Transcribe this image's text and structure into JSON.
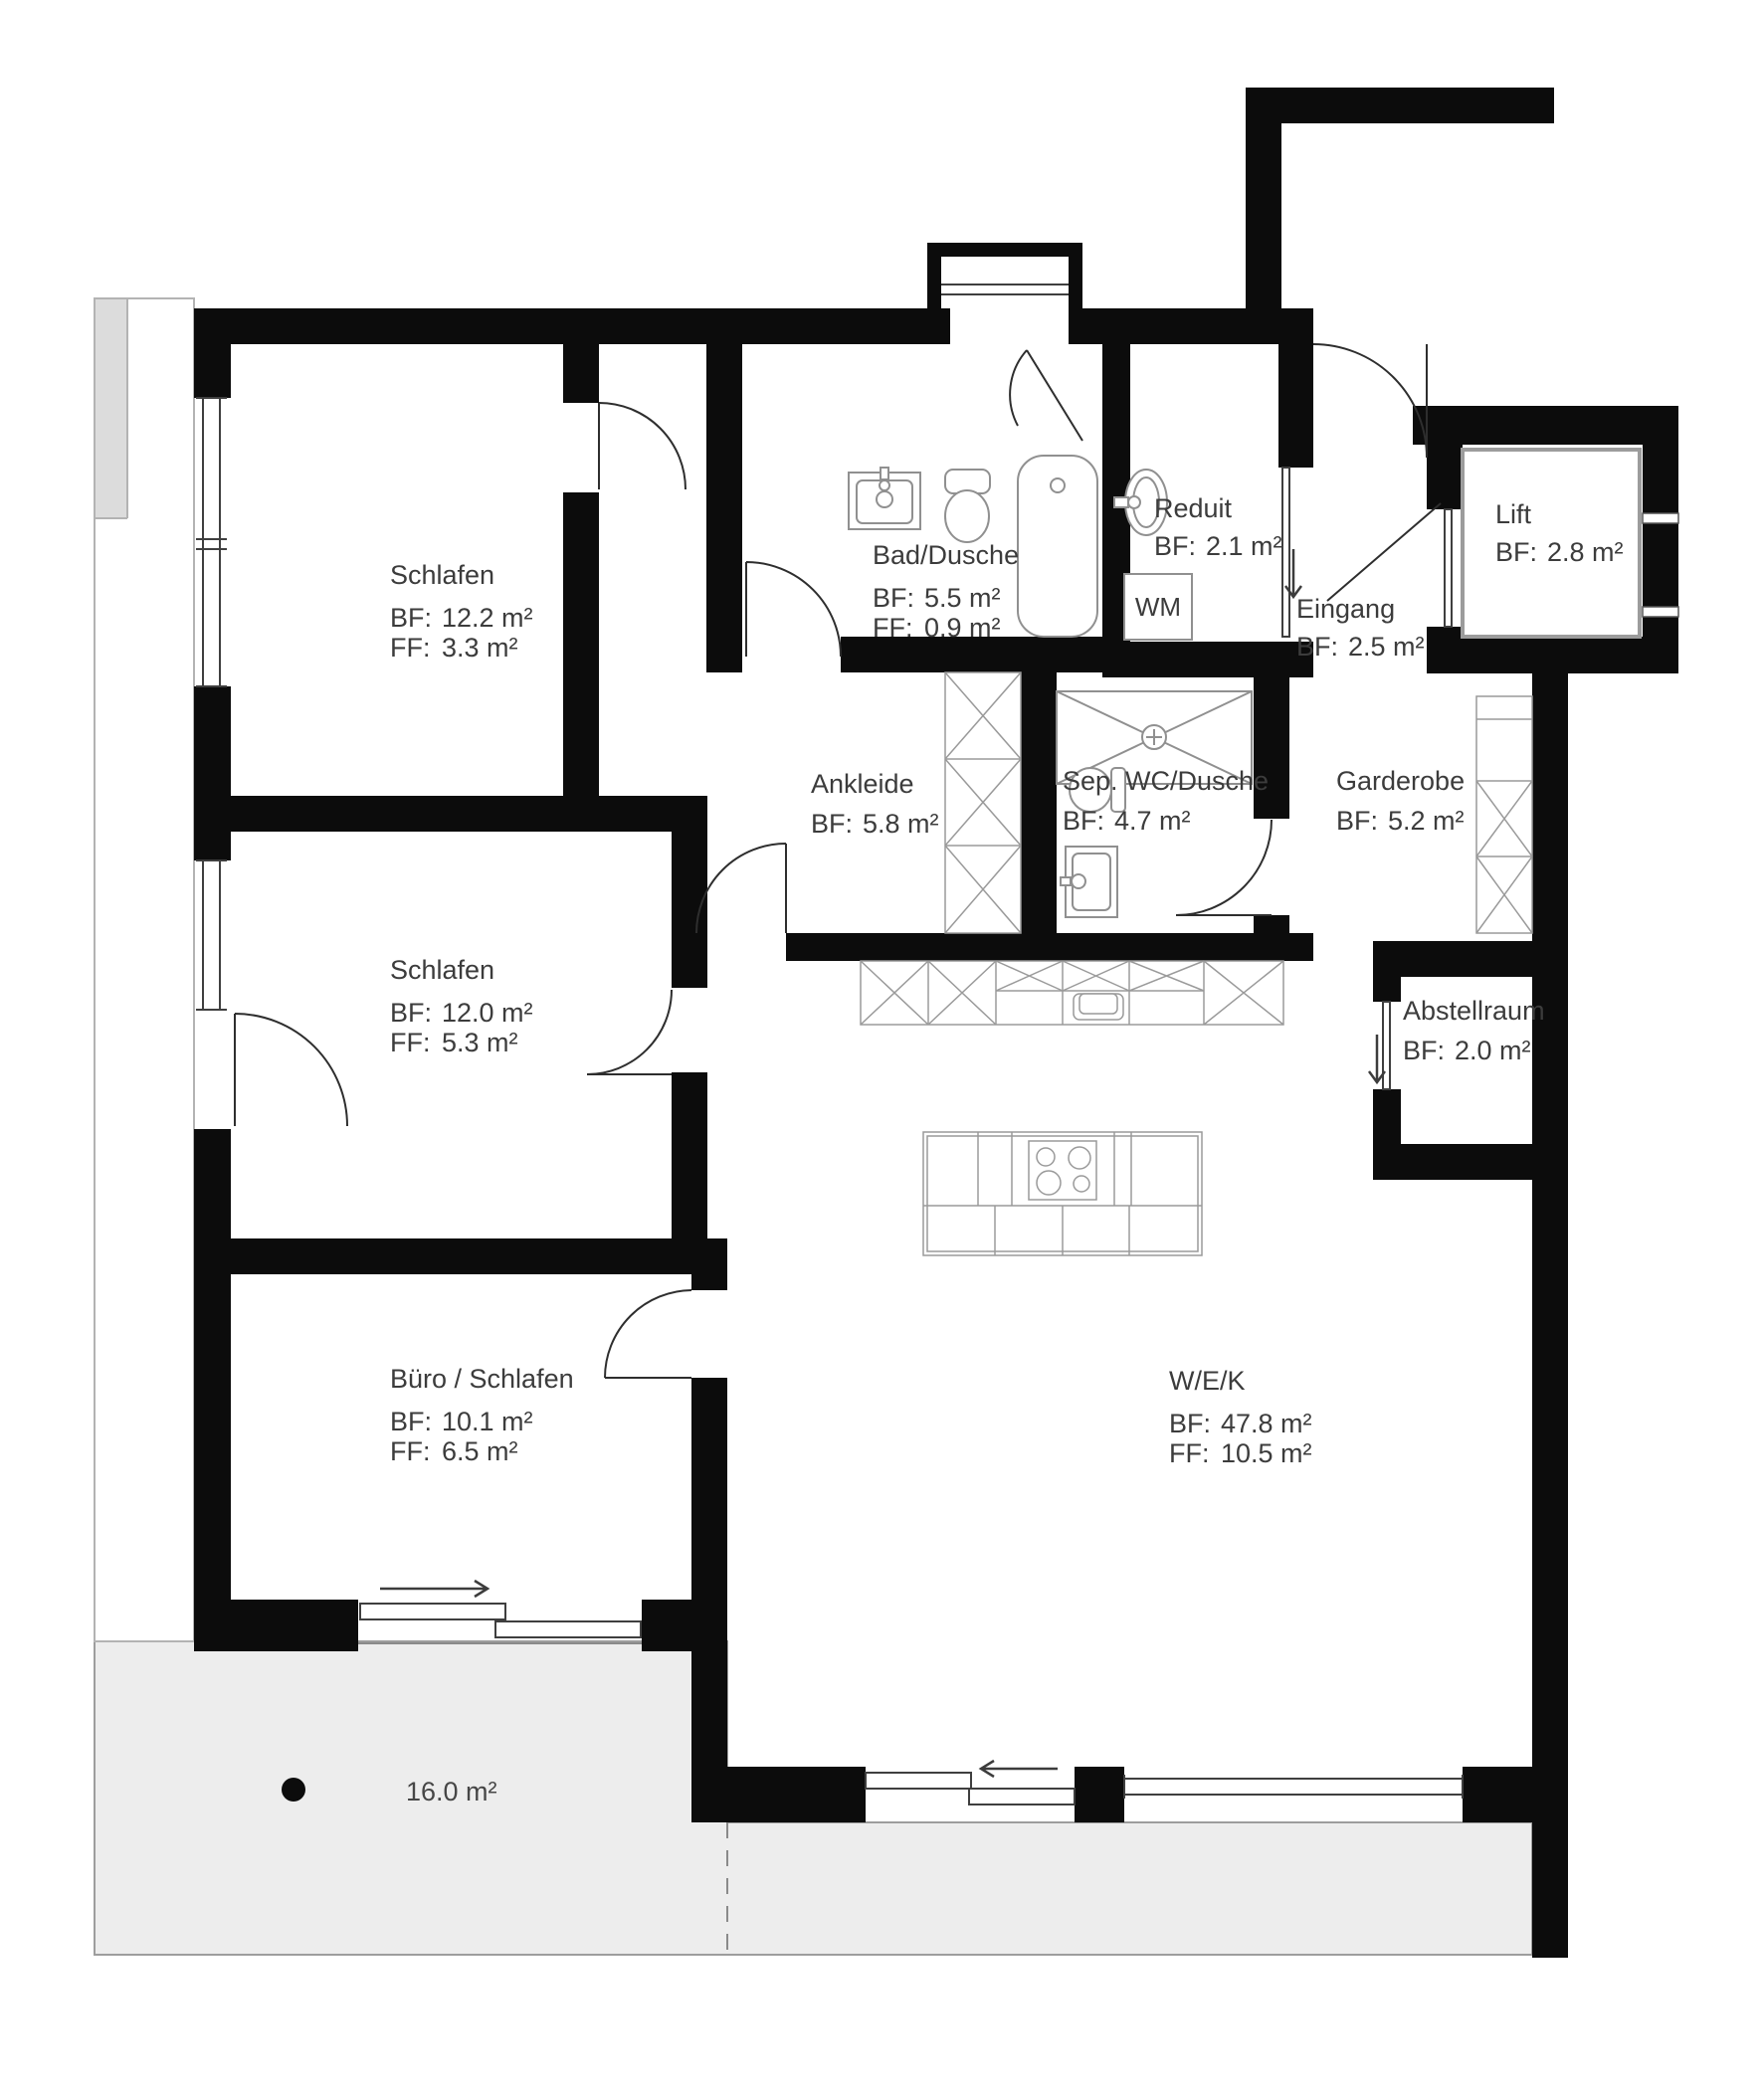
{
  "rooms": [
    {
      "id": "schlafen-1",
      "name": "Schlafen",
      "area_label": "BF:",
      "area": "12.2 m²",
      "floor_label": "FF:",
      "floor": "3.3 m²"
    },
    {
      "id": "bad-dusche",
      "name": "Bad/Dusche",
      "area_label": "BF:",
      "area": "5.5 m²",
      "floor_label": "FF:",
      "floor": "0.9 m²"
    },
    {
      "id": "reduit",
      "name": "Reduit",
      "area_label": "BF:",
      "area": "2.1 m²"
    },
    {
      "id": "eingang",
      "name": "Eingang",
      "area_label": "BF:",
      "area": "2.5 m²"
    },
    {
      "id": "lift",
      "name": "Lift",
      "area_label": "BF:",
      "area": "2.8 m²"
    },
    {
      "id": "ankleide",
      "name": "Ankleide",
      "area_label": "BF:",
      "area": "5.8 m²"
    },
    {
      "id": "sep-wc-dusche",
      "name": "Sep. WC/Dusche",
      "area_label": "BF:",
      "area": "4.7 m²"
    },
    {
      "id": "garderobe",
      "name": "Garderobe",
      "area_label": "BF:",
      "area": "5.2 m²"
    },
    {
      "id": "schlafen-2",
      "name": "Schlafen",
      "area_label": "BF:",
      "area": "12.0 m²",
      "floor_label": "FF:",
      "floor": "5.3 m²"
    },
    {
      "id": "abstellraum",
      "name": "Abstellraum",
      "area_label": "BF:",
      "area": "2.0 m²"
    },
    {
      "id": "buero-schlafen",
      "name": "Büro / Schlafen",
      "area_label": "BF:",
      "area": "10.1 m²",
      "floor_label": "FF:",
      "floor": "6.5 m²"
    },
    {
      "id": "wek",
      "name": "W/E/K",
      "area_label": "BF:",
      "area": "47.8 m²",
      "floor_label": "FF:",
      "floor": "10.5 m²"
    }
  ],
  "labels": {
    "washing_machine": "WM",
    "terrace_area": "16.0 m²"
  },
  "colors": {
    "wall": "#0c0c0c",
    "terrace_fill": "#ededed",
    "fixture_stroke": "#909090",
    "furniture_stroke": "#9a9a9a",
    "window_stroke": "#3f3f3f",
    "text": "#3c3c3c"
  }
}
